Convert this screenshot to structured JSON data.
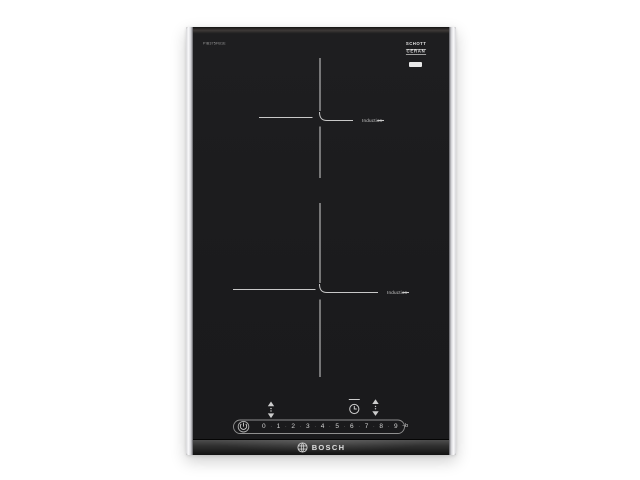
{
  "product": {
    "model": "PIB375FB1E",
    "brand": "BOSCH",
    "glass_logo": {
      "line1": "SCHOTT",
      "line2": "CERAN"
    },
    "zones": [
      {
        "label": "Induction"
      },
      {
        "label": "Induction"
      }
    ],
    "controls": {
      "levels": [
        "0",
        "1",
        "2",
        "3",
        "4",
        "5",
        "6",
        "7",
        "8",
        "9"
      ],
      "separator": "·",
      "boost_label": "–b",
      "icons": [
        "power-icon",
        "zone-select-icon",
        "timer-icon",
        "zone-select-icon"
      ]
    },
    "colors": {
      "glass_black": "#1c1c1e",
      "trim_silver": "#ececef",
      "marking_gray": "#c8c8c8",
      "logo_text": "#d9d9d9",
      "background": "#ffffff"
    }
  }
}
